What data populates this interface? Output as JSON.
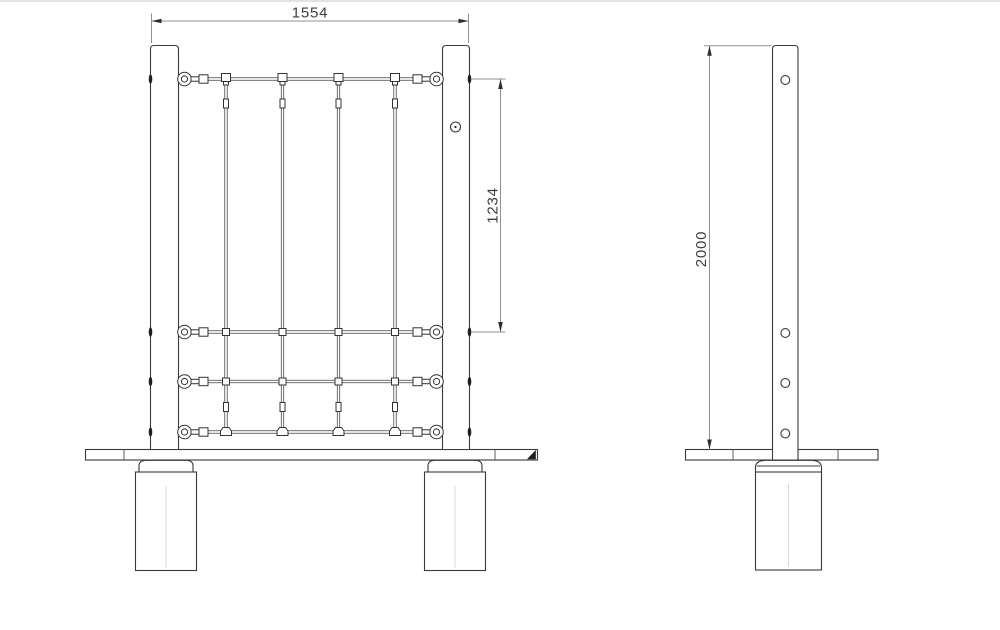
{
  "dimensions": {
    "overall_width": "1554",
    "net_height": "1234",
    "post_height": "2000"
  },
  "colors": {
    "background": "#ffffff",
    "object_line": "#3a3a3a",
    "dimension_line": "#8f8f8f",
    "dimension_text": "#3d3d3d"
  }
}
